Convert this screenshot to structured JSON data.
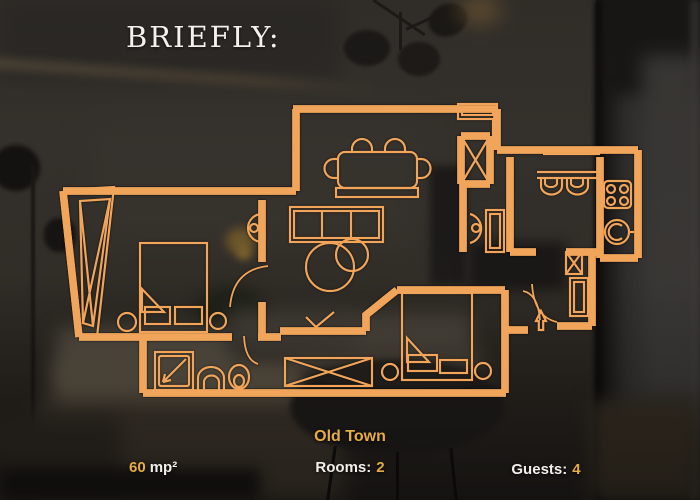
{
  "title": "BRIEFLY:",
  "footer": {
    "area": {
      "value": "60",
      "unit": "mp²"
    },
    "location": "Old Town",
    "rooms": {
      "label": "Rooms:",
      "value": "2"
    },
    "guests": {
      "label": "Guests:",
      "value": "4"
    }
  },
  "colors": {
    "accent_plan": "#F0A55A",
    "accent_text": "#E6AC45",
    "text_light": "#F2EFE9",
    "background_dark": "#34302A"
  }
}
